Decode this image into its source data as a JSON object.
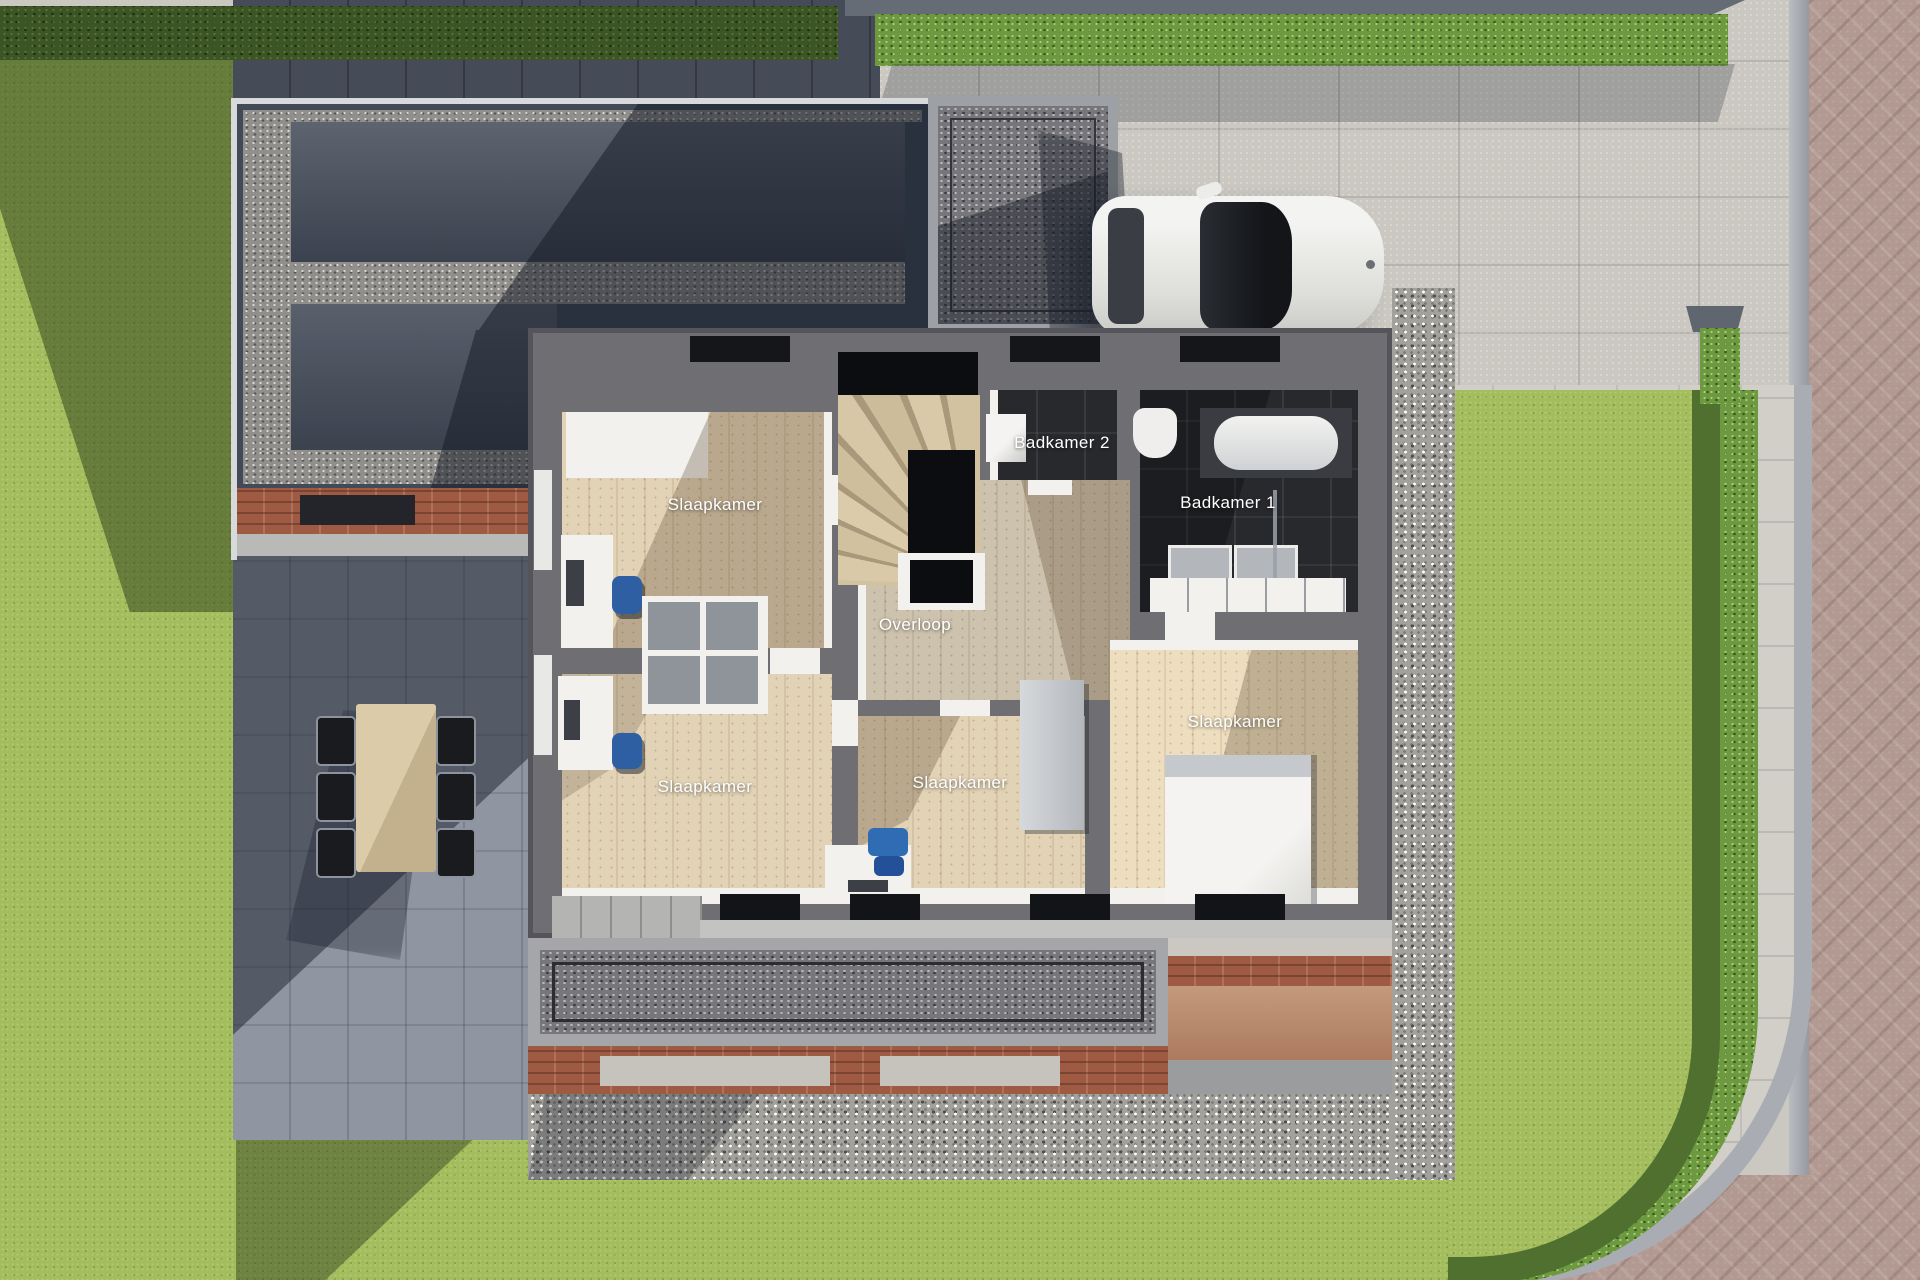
{
  "scene": {
    "kind": "3d-rendered top-down floor plan of upper storey with garden, driveway, garage roof and street"
  },
  "rooms": [
    {
      "id": "slaapkamer-nw",
      "label": "Slaapkamer"
    },
    {
      "id": "badkamer-2",
      "label": "Badkamer 2"
    },
    {
      "id": "badkamer-1",
      "label": "Badkamer 1"
    },
    {
      "id": "overloop",
      "label": "Overloop"
    },
    {
      "id": "slaapkamer-sw",
      "label": "Slaapkamer"
    },
    {
      "id": "slaapkamer-s",
      "label": "Slaapkamer"
    },
    {
      "id": "slaapkamer-se",
      "label": "Slaapkamer"
    }
  ],
  "objects": {
    "solar_panels_top_block": 8,
    "solar_panels_lower_block": 4,
    "dining_chairs": 6,
    "cars": 1
  },
  "palette": {
    "lawn": "#a3bd5d",
    "lawnShadow": "#5e7d3a",
    "hedge": "#6d9a41",
    "pavingLight": "#cbc8c2",
    "patio": "#8f96a1",
    "roadBrick": "#b29a92",
    "curb": "#a9adb3",
    "garageRoof": "#424a58",
    "gravel": "#908f8b",
    "houseWall": "#6e6e73",
    "woodFloor": "#e2d3b6",
    "darkTile": "#28292d",
    "furnitureWhite": "#f2f1ee",
    "chairBlue": "#2e5fa3",
    "brick": "#9e5a42",
    "terracotta": "#c39a7d",
    "carBody": "#e9e9e7",
    "labelText": "#ffffff"
  }
}
